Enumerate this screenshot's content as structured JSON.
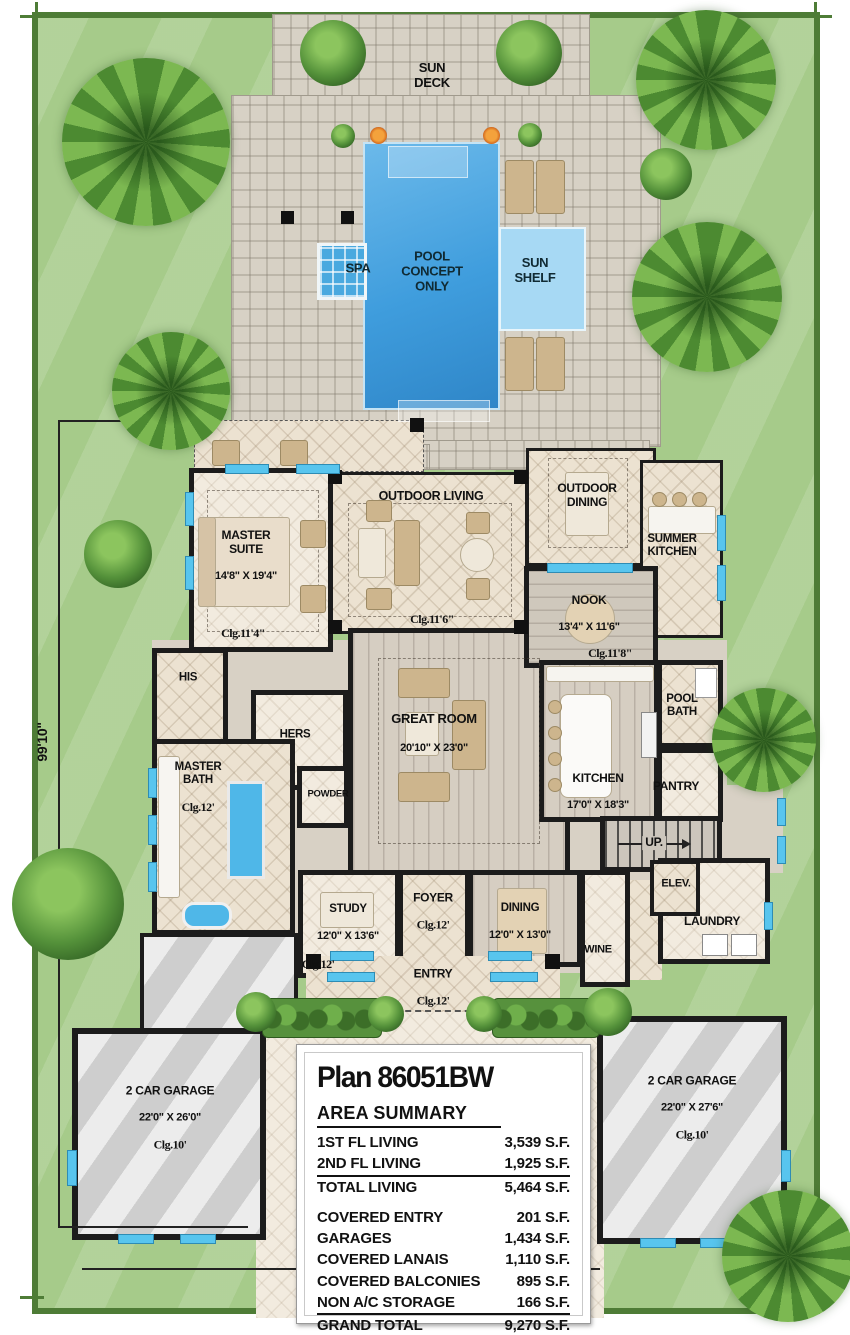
{
  "site": {
    "lot_depth": "99'10\""
  },
  "pool_deck": {
    "sun_deck": "SUN\nDECK",
    "pool": "POOL\nCONCEPT\nONLY",
    "spa": "SPA",
    "sun_shelf": "SUN\nSHELF"
  },
  "rooms": {
    "outdoor_living": {
      "name": "OUTDOOR LIVING",
      "clg": "Clg.11'6\""
    },
    "outdoor_dining": {
      "name": "OUTDOOR\nDINING"
    },
    "summer_kitchen": {
      "name": "SUMMER\nKITCHEN"
    },
    "master_suite": {
      "name": "MASTER\nSUITE",
      "dims": "14'8\" X 19'4\"",
      "clg": "Clg.11'4\""
    },
    "nook": {
      "name": "NOOK",
      "dims": "13'4\" X 11'6\"",
      "clg": "Clg.11'8\""
    },
    "great_room": {
      "name": "GREAT ROOM",
      "dims": "20'10\" X 23'0\""
    },
    "kitchen": {
      "name": "KITCHEN",
      "dims": "17'0\" X 18'3\""
    },
    "pool_bath": {
      "name": "POOL\nBATH"
    },
    "pantry": {
      "name": "PANTRY"
    },
    "his": {
      "name": "HIS"
    },
    "hers": {
      "name": "HERS"
    },
    "master_bath": {
      "name": "MASTER\nBATH",
      "clg": "Clg.12'"
    },
    "powder": {
      "name": "POWDER"
    },
    "study": {
      "name": "STUDY",
      "dims": "12'0\" X 13'6\"",
      "clg": "Clg.12'"
    },
    "foyer": {
      "name": "FOYER",
      "clg": "Clg.12'"
    },
    "dining": {
      "name": "DINING",
      "dims": "12'0\" X 13'0\""
    },
    "wine": {
      "name": "WINE"
    },
    "laundry": {
      "name": "LAUNDRY"
    },
    "elevator": {
      "name": "ELEV."
    },
    "stairs": {
      "name": "UP."
    },
    "entry": {
      "name": "ENTRY",
      "clg": "Clg.12'"
    },
    "garage_left": {
      "name": "2 CAR GARAGE",
      "dims": "22'0\" X 26'0\"",
      "clg": "Clg.10'"
    },
    "garage_right": {
      "name": "2 CAR GARAGE",
      "dims": "22'0\" X 27'6\"",
      "clg": "Clg.10'"
    }
  },
  "summary": {
    "title": "Plan 86051BW",
    "heading": "AREA SUMMARY",
    "rows": [
      {
        "label": "1ST FL LIVING",
        "value": "3,539 S.F."
      },
      {
        "label": "2ND FL LIVING",
        "value": "1,925 S.F."
      },
      {
        "label": "TOTAL LIVING",
        "value": "5,464 S.F."
      },
      {
        "label": "COVERED ENTRY",
        "value": "201 S.F."
      },
      {
        "label": "GARAGES",
        "value": "1,434 S.F."
      },
      {
        "label": "COVERED LANAIS",
        "value": "1,110 S.F."
      },
      {
        "label": "COVERED BALCONIES",
        "value": "895 S.F."
      },
      {
        "label": "NON A/C STORAGE",
        "value": "166 S.F."
      },
      {
        "label": "GRAND TOTAL",
        "value": "9,270 S.F."
      }
    ]
  },
  "colors": {
    "lawn": "#a6cb8a",
    "lot_border": "#4e7c36",
    "paver": "#d7d1c5",
    "tile": "#ece2d1",
    "wall": "#1c1c1c",
    "pool": "#3f9ddd",
    "pool_shelf": "#a7d9f4",
    "window": "#58c5ee",
    "garage_floor": "#d9d9d9",
    "tree_green": "#4c8a31"
  }
}
